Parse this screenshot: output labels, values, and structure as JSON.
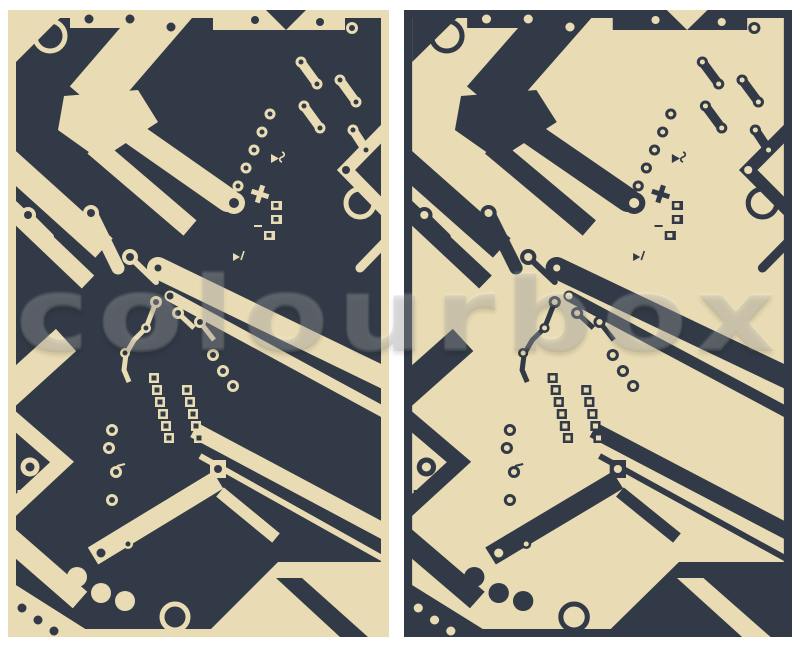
{
  "image": {
    "description": "Circuit board vector pattern shown in two inverted color versions side by side",
    "watermark_text": "colourbox"
  },
  "colors": {
    "dark": "#313A46",
    "cream": "#E9DCB4",
    "page_background": "#FFFFFF"
  },
  "panels": {
    "left": {
      "label": "dark board with light traces"
    },
    "right": {
      "label": "light board with dark traces"
    }
  }
}
